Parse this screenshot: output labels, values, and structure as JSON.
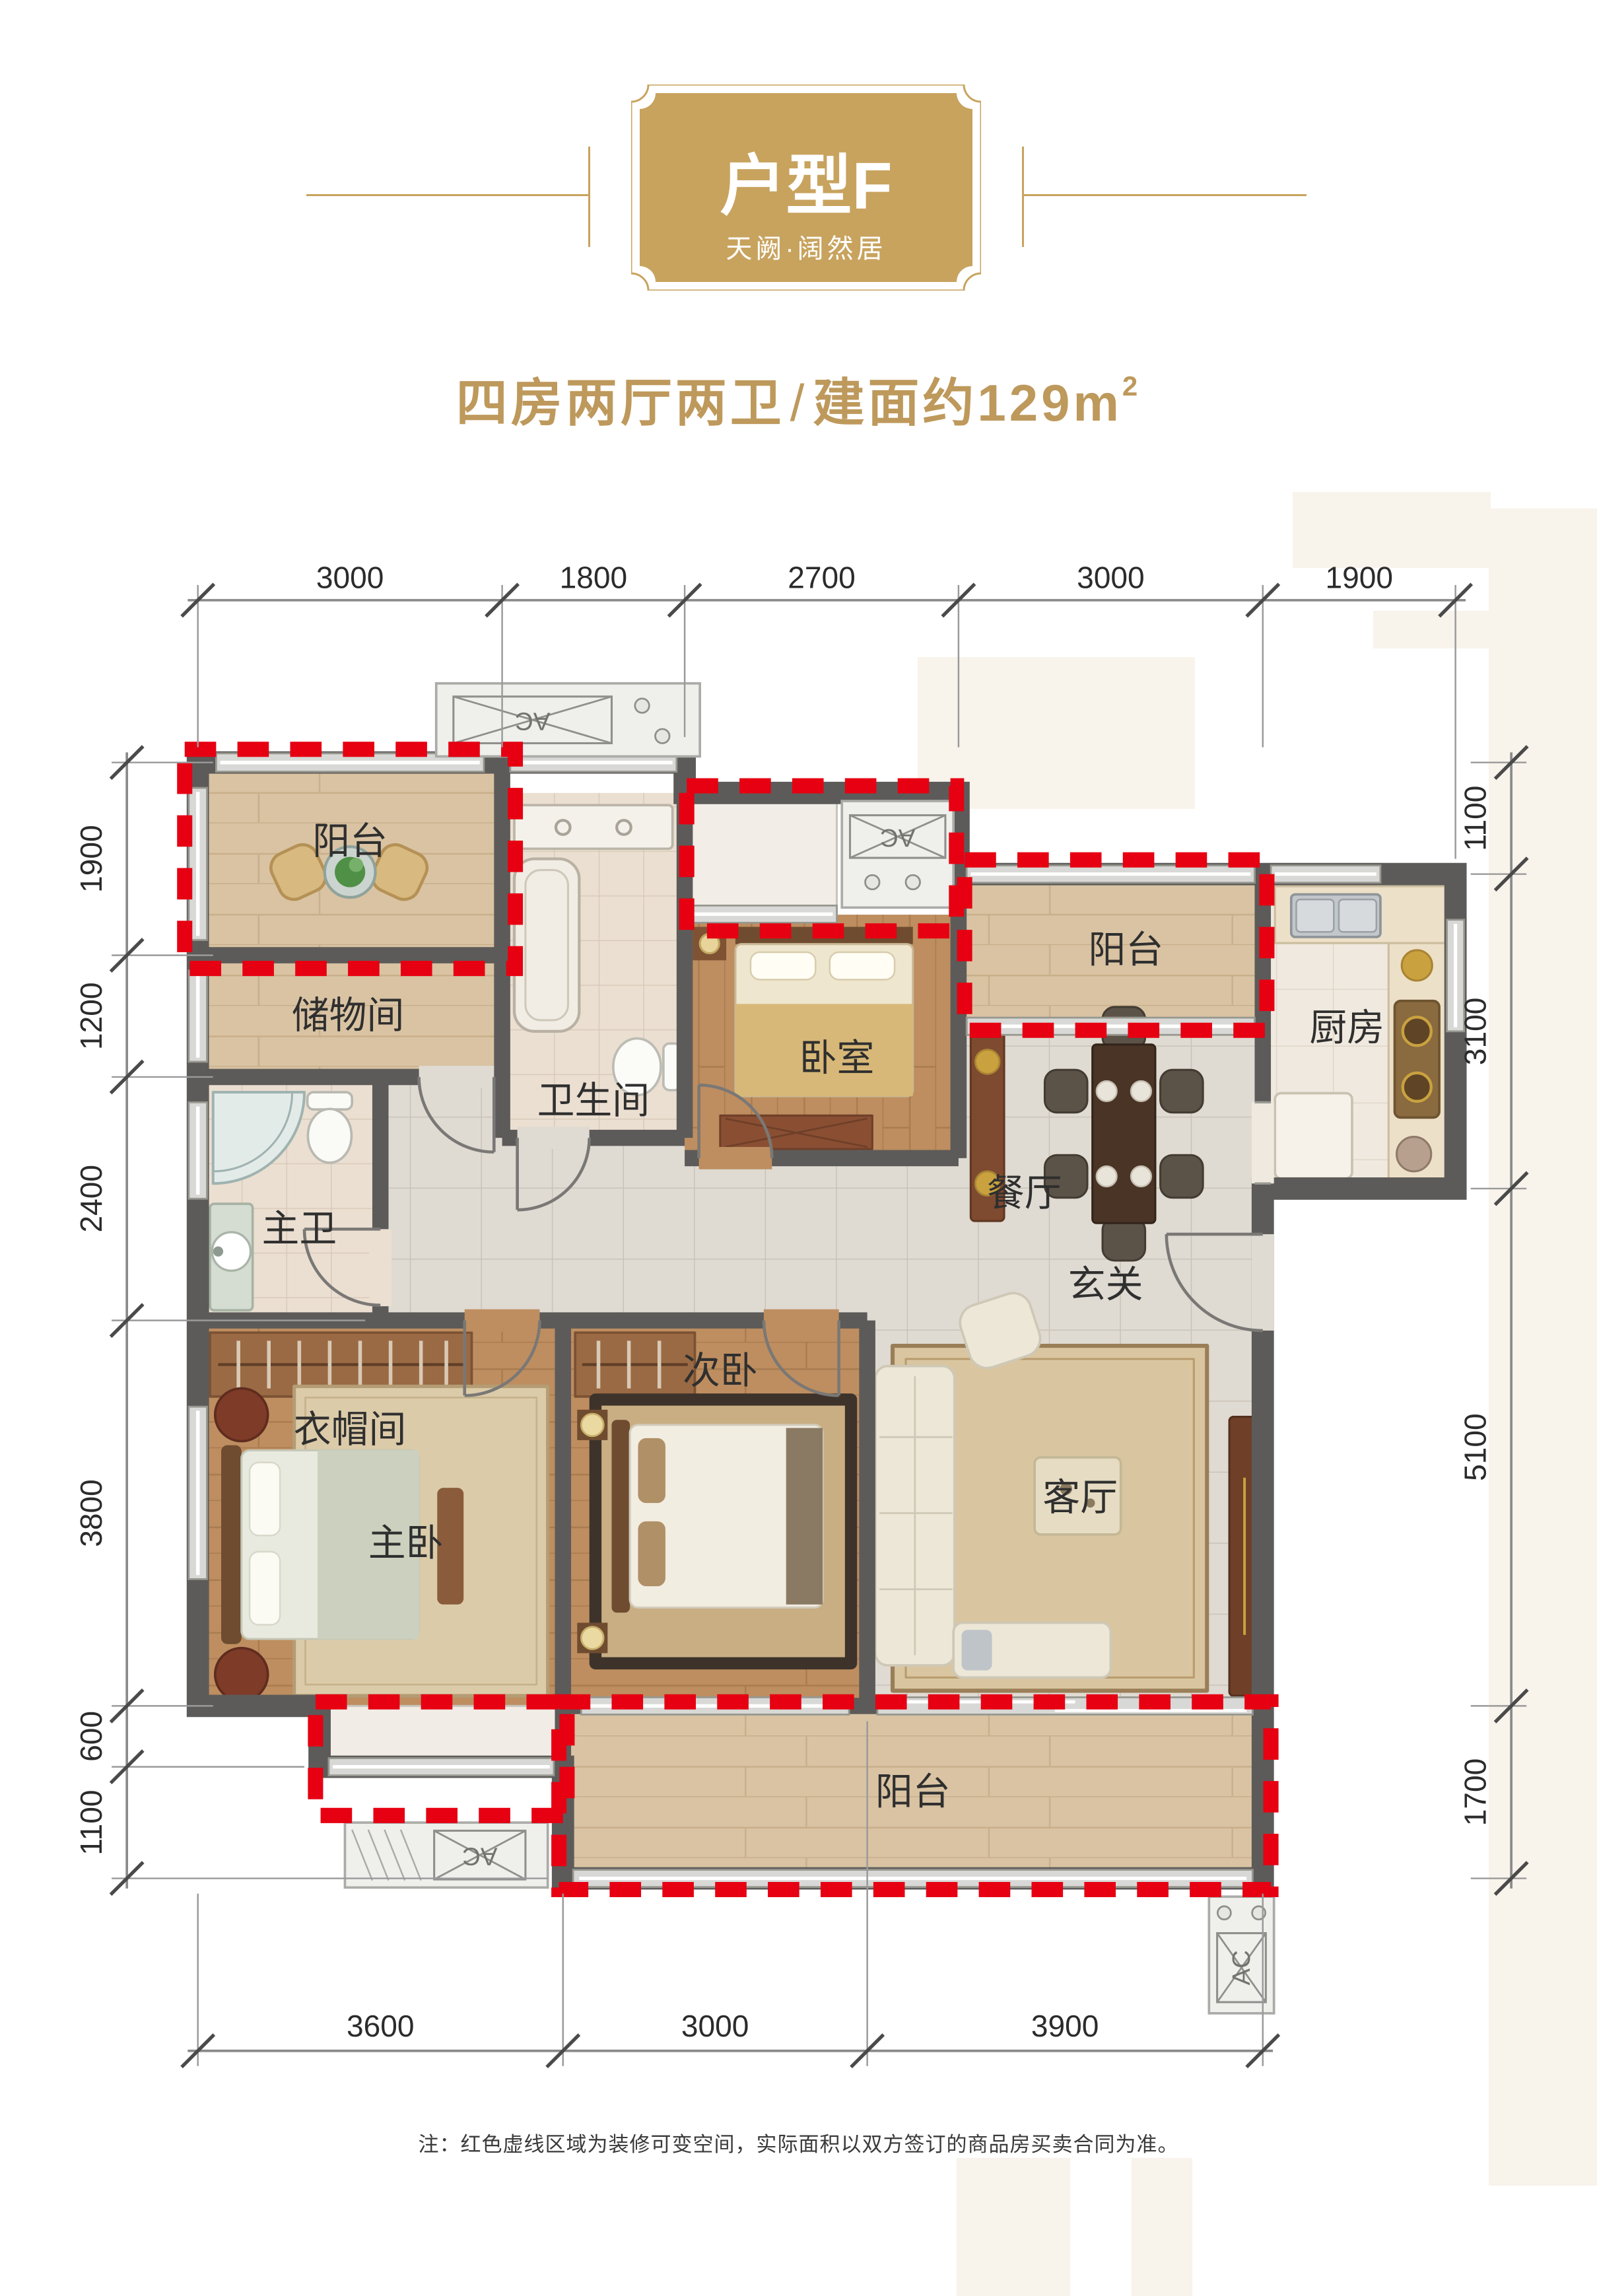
{
  "colors": {
    "gold": "#C8A35E",
    "red_dashed": "#E60012",
    "wall": "#5D5B59",
    "wood_light": "#D9C3A3",
    "wood_mid": "#BE8E60"
  },
  "header": {
    "badge": {
      "title": "户型F",
      "subtitle": "天阙·阔然居"
    },
    "summary": {
      "rooms": "四房两厅两卫",
      "divider": "/",
      "area": "建面约129m",
      "area_sup": "2"
    }
  },
  "plan": {
    "ac_label": "AC",
    "rooms": [
      {
        "id": "balcony-top-left",
        "label": "阳台"
      },
      {
        "id": "storage-room",
        "label": "储物间"
      },
      {
        "id": "bathroom",
        "label": "卫生间"
      },
      {
        "id": "bedroom-top",
        "label": "卧室"
      },
      {
        "id": "balcony-top-right",
        "label": "阳台"
      },
      {
        "id": "dining-room",
        "label": "餐厅"
      },
      {
        "id": "kitchen",
        "label": "厨房"
      },
      {
        "id": "master-bathroom",
        "label": "主卫"
      },
      {
        "id": "foyer",
        "label": "玄关"
      },
      {
        "id": "cloakroom",
        "label": "衣帽间"
      },
      {
        "id": "master-bedroom",
        "label": "主卧"
      },
      {
        "id": "second-bedroom",
        "label": "次卧"
      },
      {
        "id": "living-room",
        "label": "客厅"
      },
      {
        "id": "balcony-bottom",
        "label": "阳台"
      }
    ],
    "dims": {
      "top": [
        "3000",
        "1800",
        "2700",
        "3000",
        "1900"
      ],
      "bottom": [
        "3600",
        "3000",
        "3900"
      ],
      "left": [
        "1900",
        "1200",
        "2400",
        "3800",
        "600",
        "1100"
      ],
      "right": [
        "1100",
        "3100",
        "5100",
        "1700"
      ]
    }
  },
  "note": "注：红色虚线区域为装修可变空间，实际面积以双方签订的商品房买卖合同为准。"
}
